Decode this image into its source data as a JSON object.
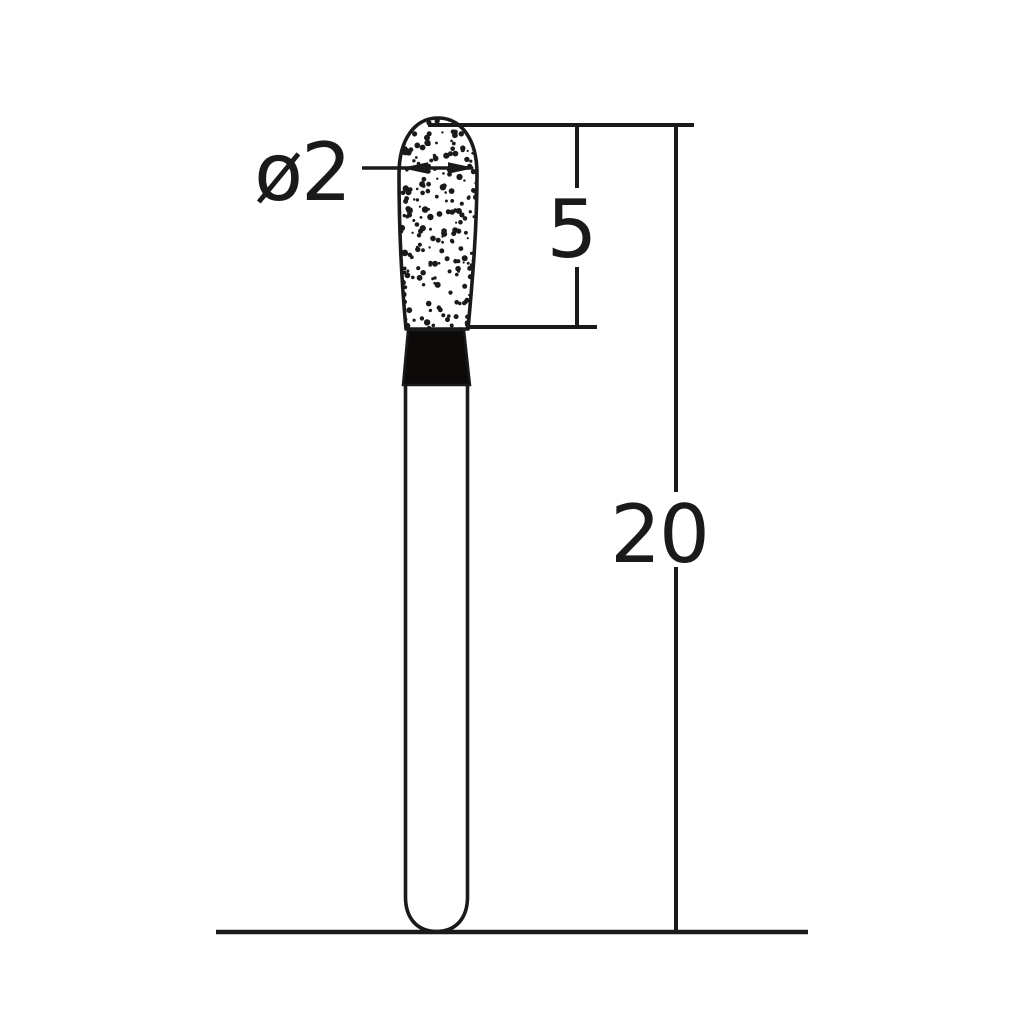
{
  "colors": {
    "ink": "#1a1a1a",
    "background": "#ffffff",
    "neck_fill": "#0d0a0a",
    "body_fill": "#ffffff"
  },
  "dimensions": {
    "head_diameter": {
      "label": "ø2"
    },
    "head_length": {
      "label": "5"
    },
    "overall_length": {
      "label": "20"
    }
  }
}
